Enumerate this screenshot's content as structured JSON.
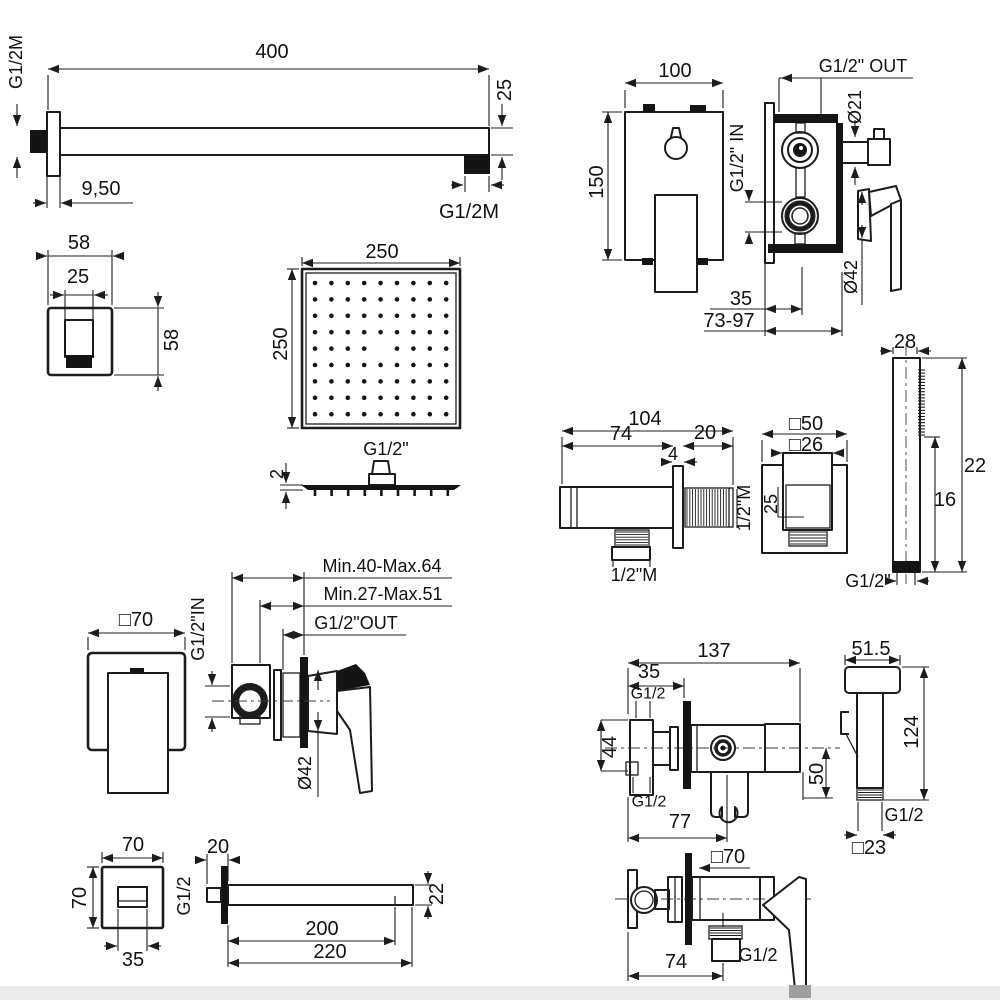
{
  "canvas": {
    "width": 1000,
    "height": 1000,
    "background": "#ffffff",
    "line_color": "#1c1c1c"
  },
  "c": {
    "arm": {
      "thread_wall": "G1/2M",
      "length": "400",
      "height": "25",
      "flange": "9,50",
      "thread_out": "G1/2M"
    },
    "flange58": {
      "w": "58",
      "inner": "25",
      "h": "58"
    },
    "mixer3": {
      "w": "100",
      "h": "150",
      "out": "G1/2\" OUT",
      "in": "G1/2\" IN",
      "dsmall": "Ø21",
      "dbig": "Ø42",
      "d35": "35",
      "drange": "73-97"
    },
    "head": {
      "w": "250",
      "h": "250",
      "thread": "G1/2\"",
      "thick": "2"
    },
    "outlet": {
      "total": "104",
      "body": "74",
      "tlen": "20",
      "flange": "4",
      "side": "1/2\"M",
      "bottom": "1/2\"M",
      "face": "□50",
      "inner": "□26",
      "ih": "25"
    },
    "wand": {
      "d": "28",
      "len": "22",
      "spray": "16",
      "thread": "G1/2\""
    },
    "mixer1": {
      "face": "□70",
      "r1": "Min.40-Max.64",
      "r2": "Min.27-Max.51",
      "out": "G1/2\"OUT",
      "in": "G1/2\"IN",
      "d": "Ø42"
    },
    "spout": {
      "w": "70",
      "h": "70",
      "inner": "35",
      "nip": "20",
      "thread": "G1/2",
      "l1": "200",
      "l2": "220",
      "bh": "22"
    },
    "valve": {
      "total": "137",
      "off": "35",
      "tt": "G1/2",
      "ih": "44",
      "tb": "G1/2",
      "hx": "77",
      "drop": "50"
    },
    "spray": {
      "w": "51.5",
      "h": "124",
      "thread": "G1/2",
      "base": "□23"
    },
    "mixer2": {
      "face": "□70",
      "ox": "74",
      "thread": "G1/2"
    }
  }
}
